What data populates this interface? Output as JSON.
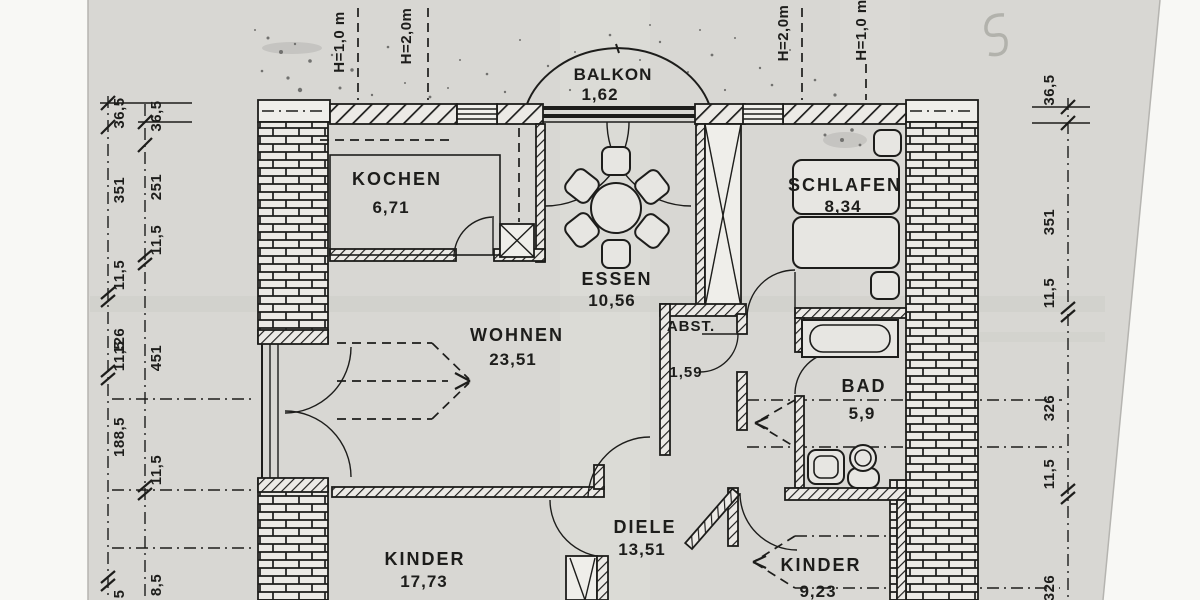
{
  "drawing": {
    "rooms": [
      {
        "name": "BALKON",
        "area": "1,62"
      },
      {
        "name": "KOCHEN",
        "area": "6,71"
      },
      {
        "name": "ESSEN",
        "area": "10,56"
      },
      {
        "name": "SCHLAFEN",
        "area": "8,34"
      },
      {
        "name": "WOHNEN",
        "area": "23,51"
      },
      {
        "name": "ABST.",
        "area": "1,59"
      },
      {
        "name": "BAD",
        "area": "5,9"
      },
      {
        "name": "DIELE",
        "area": "13,51"
      },
      {
        "name": "KINDER",
        "area": "17,73"
      },
      {
        "name": "KINDER",
        "area": "9,23"
      }
    ],
    "height_marks": {
      "left_outer": "H=1,0 m",
      "left_inner": "H=2,0m",
      "right_inner": "H=2,0m",
      "right_outer": "H=1,0 m"
    },
    "dims": {
      "left_outer": [
        "36,5",
        "351",
        "11,5",
        "126",
        "11,5",
        "188,5",
        "5"
      ],
      "left_inner": [
        "36,5",
        "251",
        "11,5",
        "451",
        "11,5",
        "8,5"
      ],
      "right": [
        "36,5",
        "351",
        "11,5",
        "326",
        "11,5",
        "326"
      ]
    },
    "handwritten_mark": "5",
    "ink": "#1d1d1b",
    "paper": "#d8d7d3"
  }
}
